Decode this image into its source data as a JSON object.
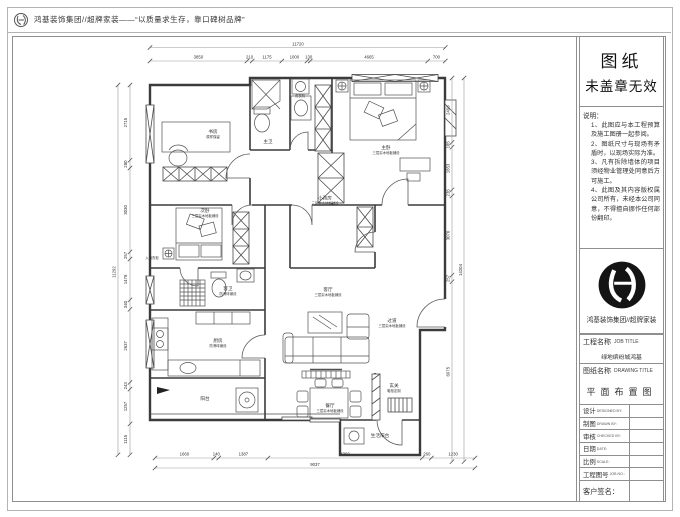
{
  "header": {
    "slogan": "鸿基装饰集团//超牌家装——“以质量求生存，靠口碑树品牌”"
  },
  "title_block": {
    "stamp_line1": "图纸",
    "stamp_line2": "未盖章无效",
    "notes_title": "说明：",
    "notes": [
      "1、此图应与本工程预算及施工图册一起参阅。",
      "2、图纸尺寸与现场有矛盾时，以现场实际为准。",
      "3、凡有拆除墙体的项目须经物业管理处同意后方可施工。",
      "4、此图及其内容版权属公司所有，未经本公司同意，不得擅自挪作任何部份翻印。"
    ],
    "company": "鸿基装饰集团//超牌家装",
    "job_label": "工程名称",
    "job_label_en": "JOB TITLE",
    "job_value": "绿地缤纷城鸿基",
    "drawing_label": "图纸名称",
    "drawing_label_en": "DRAWING TITLE",
    "drawing_value": "平面布置图",
    "rows": [
      {
        "cn": "设计",
        "en": "DESIGNED BY:"
      },
      {
        "cn": "制图",
        "en": "DRAWN BY:"
      },
      {
        "cn": "审核",
        "en": "CHECKED BY:"
      },
      {
        "cn": "日期",
        "en": "DATE:"
      },
      {
        "cn": "比例",
        "en": "SCALE:"
      },
      {
        "cn": "工程图号",
        "en": "JOB NO.:"
      }
    ],
    "customer_sign": "客户签名："
  },
  "floor_plan": {
    "rooms": [
      {
        "name": "书房",
        "note": "原样保留"
      },
      {
        "name": "主卫",
        "note": ""
      },
      {
        "name": "主卧",
        "note": "三层实木地板铺设"
      },
      {
        "name": "次卧",
        "note": "三层实木地板铺设"
      },
      {
        "name": "小孩房",
        "note": "三层实木地板铺设"
      },
      {
        "name": "客卫",
        "note": "防滑砖铺设"
      },
      {
        "name": "厨房",
        "note": "防滑砖铺设"
      },
      {
        "name": "阳台",
        "note": ""
      },
      {
        "name": "客厅",
        "note": "三层实木地板铺设"
      },
      {
        "name": "餐厅",
        "note": "三层实木地板铺设"
      },
      {
        "name": "过道",
        "note": "三层实木地板铺设"
      },
      {
        "name": "玄关",
        "note": "鞋柜定制"
      },
      {
        "name": "生活阳台",
        "note": ""
      }
    ],
    "fixtures": [
      "洗衣机",
      "入墙衣柜"
    ],
    "dimensions": {
      "top": {
        "overall": "11720",
        "segments": [
          "3850",
          "210",
          "1175",
          "1000",
          "130",
          "4665",
          "700"
        ]
      },
      "bottom": {
        "overall": "9037",
        "segments": [
          "1660",
          "140",
          "1387",
          "4360",
          "260",
          "1230"
        ]
      },
      "left": {
        "overall": "11292",
        "segments": [
          "2715",
          "280",
          "3030",
          "257",
          "1478",
          "340",
          "2637",
          "243",
          "1257",
          "1115"
        ]
      },
      "right": {
        "overall": "14204",
        "segments": [
          "2498",
          "185",
          "1653",
          "235",
          "3070",
          "257",
          "6975"
        ]
      }
    }
  },
  "colors": {
    "wall": "#3b3b3b",
    "furniture": "#515151",
    "dimension_line": "#9a9a9a",
    "dimension_text": "#333333",
    "frame": "#8f8f8f"
  }
}
